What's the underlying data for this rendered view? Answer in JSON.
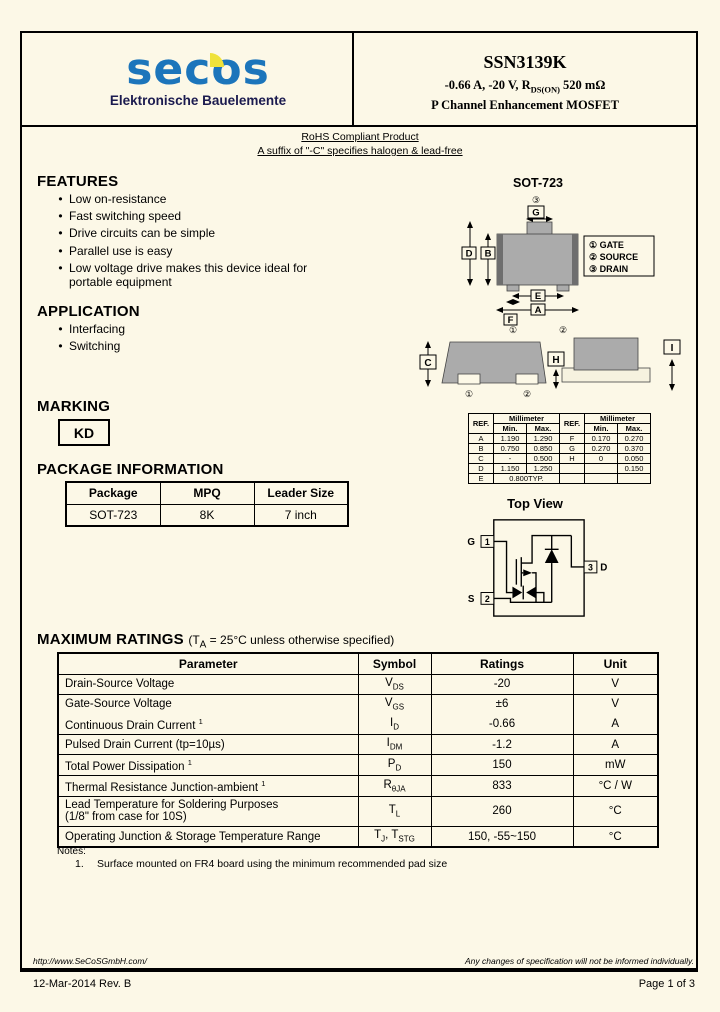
{
  "colors": {
    "brand_blue": "#1C75BB",
    "brand_yellow": "#EFE23A",
    "body_gray": "#ABABAB",
    "cap_gray": "#6E6E6E",
    "page_cream": "#FCF8E7"
  },
  "header": {
    "brand": "secos",
    "brand_tagline": "Elektronische Bauelemente",
    "part_number": "SSN3139K",
    "spec_line": [
      {
        "t": "-0.66 A, -20 V, R"
      },
      {
        "s": "DS(ON)"
      },
      {
        "t": " 520 mΩ"
      }
    ],
    "type_line": "P Channel Enhancement MOSFET"
  },
  "compliance": {
    "line1": "RoHS Compliant Product",
    "line2": "A suffix of \"-C\" specifies halogen & lead-free"
  },
  "features": {
    "title": "FEATURES",
    "items": [
      "Low on-resistance",
      "Fast switching speed",
      "Drive circuits can be simple",
      "Parallel use is easy",
      "Low voltage drive makes this device ideal for\nportable equipment"
    ]
  },
  "application": {
    "title": "APPLICATION",
    "items": [
      "Interfacing",
      "Switching"
    ]
  },
  "package_drawing": {
    "title": "SOT-723",
    "pin_legend": [
      "① GATE",
      "② SOURCE",
      "③ DRAIN"
    ],
    "dim_labels": {
      "A": "A",
      "B": "B",
      "C": "C",
      "D": "D",
      "E": "E",
      "F": "F",
      "G": "G",
      "H": "H",
      "I": "I"
    },
    "pin_numbers": {
      "p1": "①",
      "p2": "②",
      "p3": "③"
    }
  },
  "marking": {
    "title": "MARKING",
    "code": "KD"
  },
  "dimensions": {
    "head": {
      "ref": "REF.",
      "unit": "Millimeter",
      "min": "Min.",
      "max": "Max."
    },
    "rows": [
      {
        "ref": "A",
        "min": "1.190",
        "max": "1.290",
        "ref2": "F",
        "min2": "0.170",
        "max2": "0.270"
      },
      {
        "ref": "B",
        "min": "0.750",
        "max": "0.850",
        "ref2": "G",
        "min2": "0.270",
        "max2": "0.370"
      },
      {
        "ref": "C",
        "min": "-",
        "max": "0.500",
        "ref2": "H",
        "min2": "0",
        "max2": "0.050"
      },
      {
        "ref": "D",
        "min": "1.150",
        "max": "1.250",
        "ref2": "",
        "min2": "",
        "max2": "0.150"
      },
      {
        "ref": "E",
        "span": "0.800TYP.",
        "ref2": "",
        "min2": "",
        "max2": ""
      }
    ]
  },
  "package_info": {
    "title": "PACKAGE INFORMATION",
    "headers": [
      "Package",
      "MPQ",
      "Leader Size"
    ],
    "rows": [
      [
        "SOT-723",
        "8K",
        "7 inch"
      ]
    ]
  },
  "schematic": {
    "title": "Top View",
    "pins": {
      "g": "G",
      "s": "S",
      "d": "D",
      "n1": "1",
      "n2": "2",
      "n3": "3"
    }
  },
  "max_ratings": {
    "title": "MAXIMUM RATINGS",
    "condition": [
      {
        "t": "(T"
      },
      {
        "s": "A"
      },
      {
        "t": " = 25°C unless otherwise specified)"
      }
    ],
    "headers": [
      "Parameter",
      "Symbol",
      "Ratings",
      "Unit"
    ],
    "rows": [
      {
        "param": [
          {
            "t": "Drain-Source Voltage"
          }
        ],
        "symbol": [
          {
            "t": "V"
          },
          {
            "s": "DS"
          }
        ],
        "rating": "-20",
        "unit": "V"
      },
      {
        "param": [
          {
            "t": "Gate-Source Voltage"
          }
        ],
        "symbol": [
          {
            "t": "V"
          },
          {
            "s": "GS"
          }
        ],
        "rating": "±6",
        "unit": "V",
        "merge_below": true
      },
      {
        "param": [
          {
            "t": "Continuous Drain Current "
          },
          {
            "p": "1"
          }
        ],
        "symbol": [
          {
            "t": "I"
          },
          {
            "s": "D"
          }
        ],
        "rating": "-0.66",
        "unit": "A"
      },
      {
        "param": [
          {
            "t": "Pulsed Drain Current (tp=10µs)"
          }
        ],
        "symbol": [
          {
            "t": "I"
          },
          {
            "s": "DM"
          }
        ],
        "rating": "-1.2",
        "unit": "A"
      },
      {
        "param": [
          {
            "t": "Total Power Dissipation "
          },
          {
            "p": "1"
          }
        ],
        "symbol": [
          {
            "t": "P"
          },
          {
            "s": "D"
          }
        ],
        "rating": "150",
        "unit": "mW"
      },
      {
        "param": [
          {
            "t": "Thermal Resistance Junction-ambient "
          },
          {
            "p": "1"
          }
        ],
        "symbol": [
          {
            "t": "R"
          },
          {
            "s": "θJA"
          }
        ],
        "rating": "833",
        "unit": "°C / W"
      },
      {
        "param": [
          {
            "t": "Lead Temperature for Soldering Purposes\n(1/8\" from case for 10S)"
          }
        ],
        "symbol": [
          {
            "t": "T"
          },
          {
            "s": "L"
          }
        ],
        "rating": "260",
        "unit": "°C"
      },
      {
        "param": [
          {
            "t": "Operating Junction & Storage Temperature Range"
          }
        ],
        "symbol": [
          {
            "t": "T"
          },
          {
            "s": "J"
          },
          {
            "t": ", T"
          },
          {
            "s": "STG"
          }
        ],
        "rating": "150, -55~150",
        "unit": "°C"
      }
    ],
    "notes_label": "Notes:",
    "notes": [
      {
        "num": "1.",
        "text": "Surface mounted on FR4 board using the minimum recommended pad size"
      }
    ]
  },
  "footer": {
    "url": "http://www.SeCoSGmbH.com/",
    "disclaimer": "Any changes of specification will not be informed individually.",
    "date_rev": "12-Mar-2014 Rev. B",
    "page": "Page  1  of  3"
  }
}
